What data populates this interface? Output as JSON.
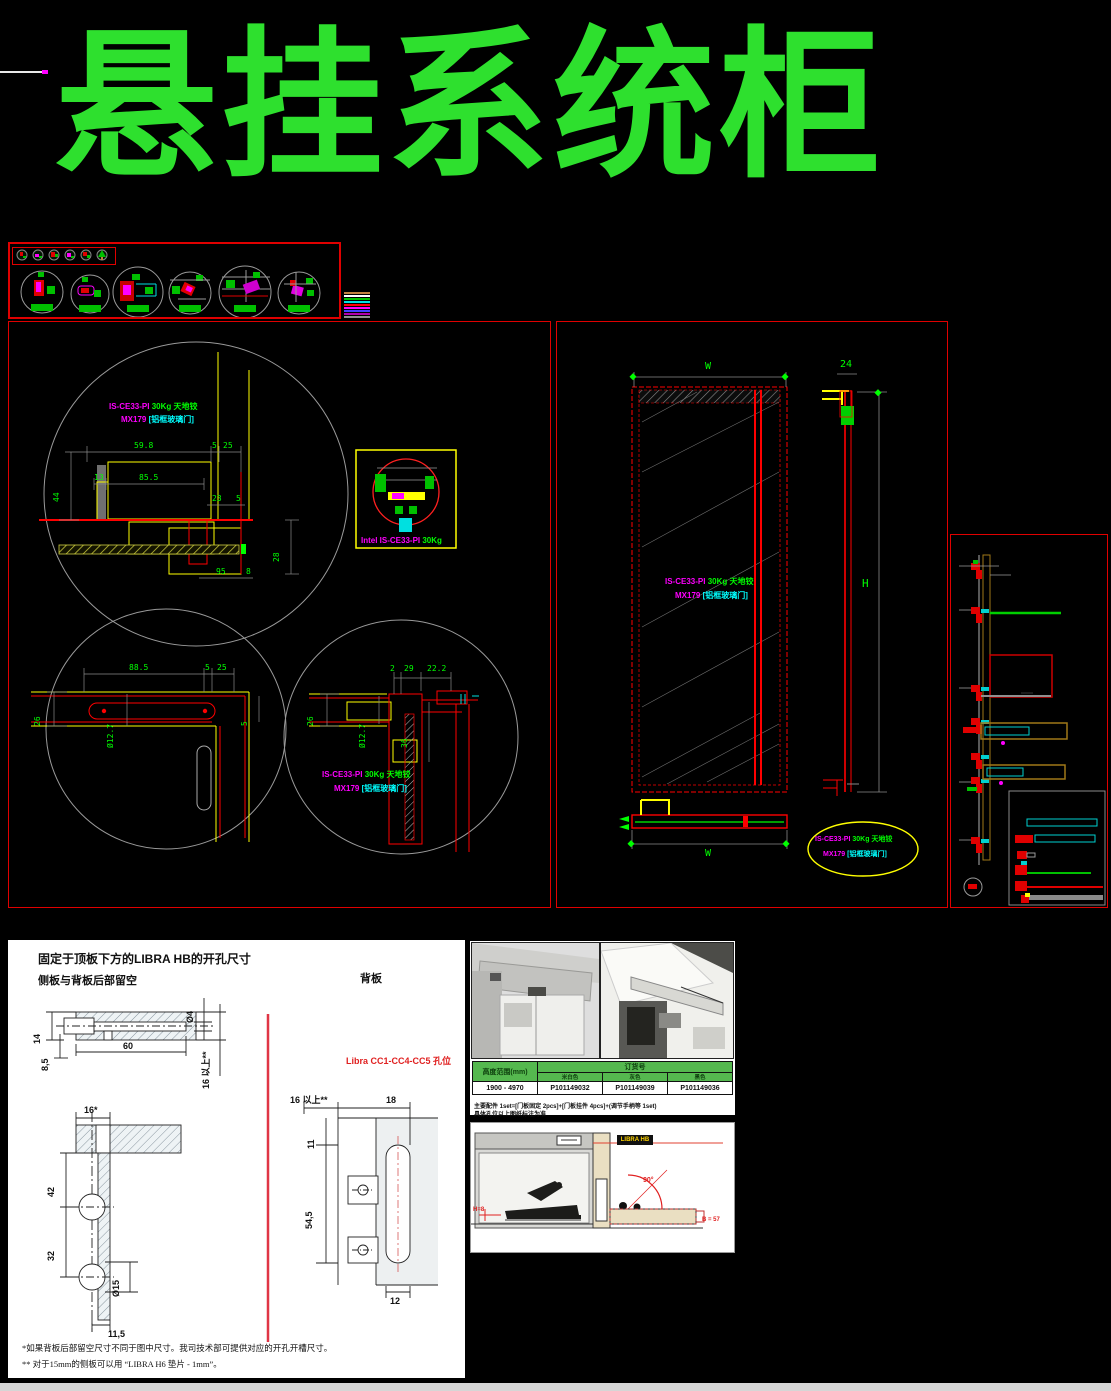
{
  "title": "悬挂系统柜",
  "hinge": {
    "code": "IS-CE33-PI",
    "weight": "30Kg 天地铰",
    "model": "MX179",
    "door_type": "[铝框玻璃门]",
    "intel_code": "Intel IS-CE33-PI",
    "intel_weight": "30Kg"
  },
  "door_view": {
    "top_width": "W",
    "thickness": "24",
    "height": "H",
    "bottom_width": "W"
  },
  "detail1": {
    "dims": {
      "d1": "59.8",
      "d2": "5",
      "d3": "25",
      "d4": "13",
      "d5": "85.5",
      "d6": "44",
      "d7": "23",
      "d8": "5",
      "d9": "28",
      "d10": "95",
      "d11": "8"
    }
  },
  "detail2": {
    "dims": {
      "d1": "88.5",
      "d2": "5",
      "d3": "25",
      "d4": "26",
      "d5": "Ø12.7",
      "d6": "5"
    }
  },
  "detail3": {
    "dims": {
      "d1": "2",
      "d2": "29",
      "d3": "22.2",
      "d4": "26",
      "d5": "Ø12.7",
      "d6": "36"
    }
  },
  "drill_panel": {
    "heading1": "固定于顶板下方的LIBRA HB的开孔尺寸",
    "heading2": "侧板与背板后部留空",
    "back_panel_label": "背板",
    "cc_label": "Libra CC1-CC4-CC5 孔位",
    "dims": {
      "a1": "14",
      "a2": "8,5",
      "a3": "60",
      "a4": "Ø4",
      "a5": "16 以上**",
      "b1": "16*",
      "b2": "42",
      "b3": "32",
      "b4": "Ø15",
      "b5": "11,5",
      "c1": "16 以上**",
      "c2": "18",
      "c3": "11",
      "c4": "54,5",
      "c5": "12"
    },
    "footnote1": "*如果背板后部留空尺寸不同于图中尺寸。我司技术部可提供对应的开孔开槽尺寸。",
    "footnote2": "** 对于15mm的侧板可以用 “LIBRA H6 垫片 - 1mm”。"
  },
  "order_table": {
    "header_left": "高度范围(mm)",
    "header_right": "订货号",
    "sub_headers": {
      "s1": "米白色",
      "s2": "灰色",
      "s3": "黑色"
    },
    "row": {
      "range": "1900 - 4970",
      "code1": "P101149032",
      "code2": "P101149039",
      "code3": "P101149036"
    },
    "note1": "主要配件 1set=[门板固定 2pcs]+[门板挂件 4pcs]+(调节手柄等 1set)",
    "note2": "具体孔位以上图纸标注为准"
  },
  "install_drawing": {
    "tag": "LIBRA HB",
    "angle": "90°",
    "dim_right": "B = 57",
    "dim_left": "H=8"
  }
}
